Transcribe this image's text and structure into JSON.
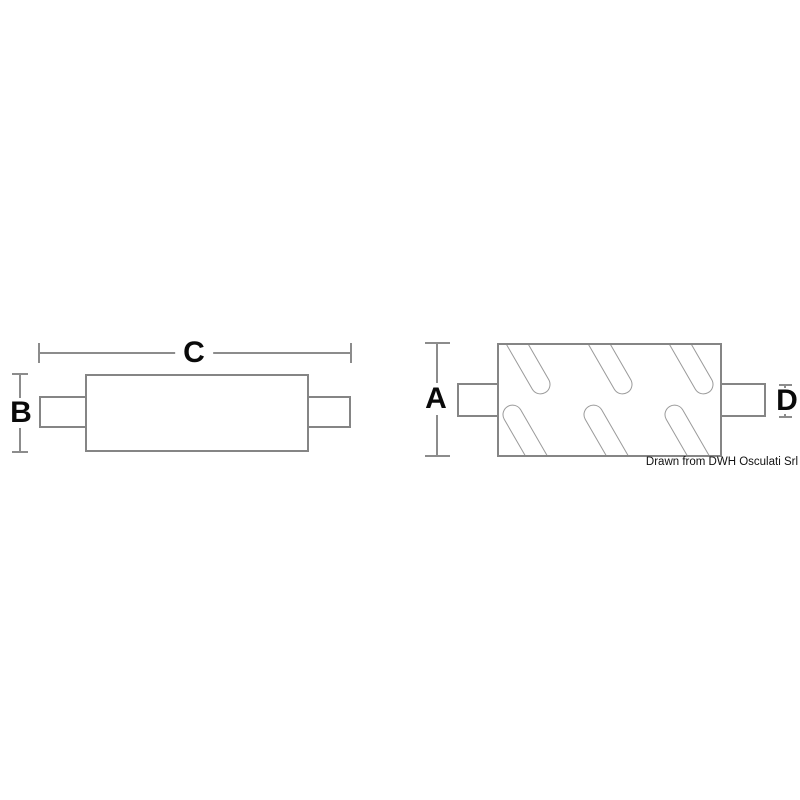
{
  "drawing": {
    "type": "technical-diagram",
    "subject": "exhaust muffler with inlet and outlet pipes, two orthographic views",
    "credit": "Drawn from DWH Osculati Srl",
    "colors": {
      "background": "#ffffff",
      "part_outline": "#858585",
      "slot_outline": "#9a9a9a",
      "dimension_line": "#8c8c8c",
      "label_text": "#0a0a0a"
    },
    "side_view": {
      "description": "side view: long body with pipe stubs left and right",
      "dim_total_length_label": "C",
      "dim_body_height_label": "B"
    },
    "end_view": {
      "description": "top view: body with six diagonal rounded slots, pipe stubs left and right",
      "dim_body_height_label": "A",
      "dim_pipe_height_label": "D",
      "slot_count": 6
    }
  }
}
